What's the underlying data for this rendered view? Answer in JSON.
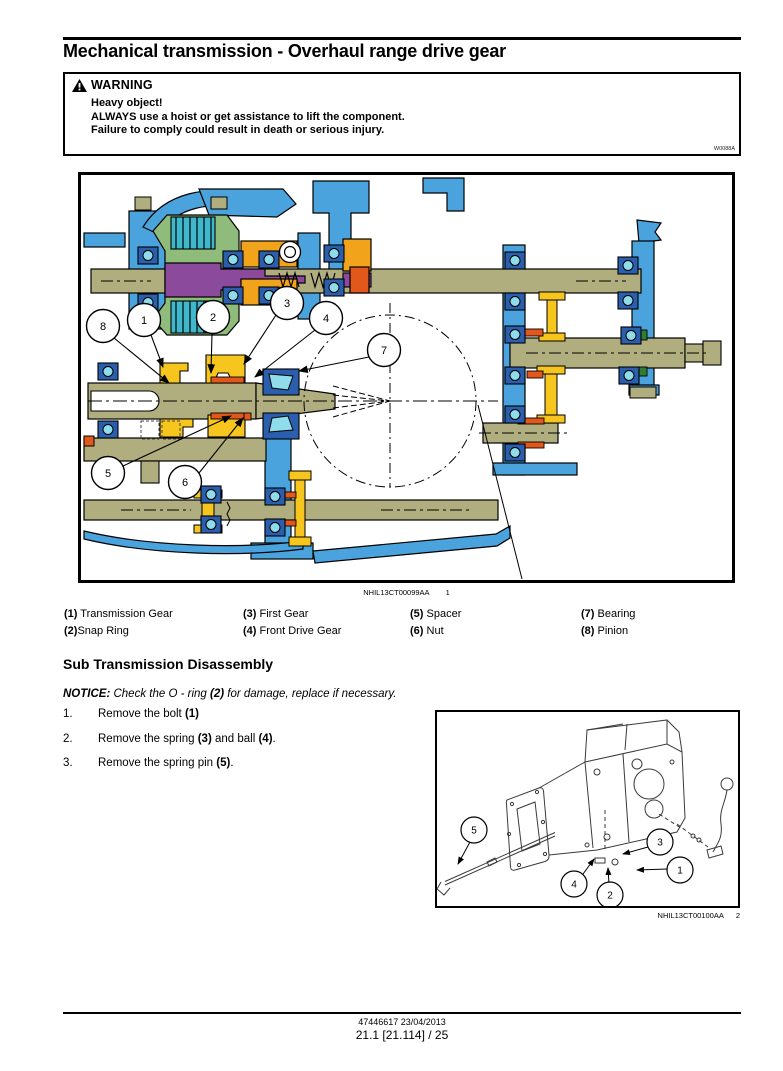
{
  "page": {
    "header": "Transmission - Mechanical transmission",
    "title": "Mechanical transmission - Overhaul range drive gear",
    "footer": {
      "line1": "47446617 23/04/2013",
      "line2": "21.1 [21.114] / 25"
    }
  },
  "warning": {
    "title": "WARNING",
    "lines": [
      "Heavy object!",
      "ALWAYS use a hoist or get assistance to lift the component.",
      "Failure to comply could result in death or serious injury."
    ],
    "code": "W0088A"
  },
  "figure1": {
    "caption_code": "NHIL13CT00099AA",
    "caption_num": "1",
    "callouts": [
      "8",
      "1",
      "2",
      "3",
      "4",
      "7",
      "5",
      "6"
    ]
  },
  "legend": {
    "items": [
      {
        "num": "(1)",
        "label": " Transmission Gear"
      },
      {
        "num": "(2)",
        "label": "Snap Ring"
      },
      {
        "num": "(3)",
        "label": " First Gear"
      },
      {
        "num": "(4)",
        "label": " Front Drive Gear"
      },
      {
        "num": "(5)",
        "label": " Spacer"
      },
      {
        "num": "(6)",
        "label": " Nut"
      },
      {
        "num": "(7)",
        "label": " Bearing"
      },
      {
        "num": "(8)",
        "label": " Pinion"
      }
    ]
  },
  "section": {
    "heading": "Sub Transmission Disassembly",
    "notice": {
      "label": "NOTICE:",
      "t1": " Check the O - ring ",
      "b1": "(2)",
      "t2": " for damage, replace if necessary."
    },
    "steps": [
      {
        "num": "1.",
        "t1": "Remove the bolt ",
        "b1": "(1)",
        "t2": "",
        "b2": "",
        "t3": ""
      },
      {
        "num": "2.",
        "t1": "Remove the spring ",
        "b1": "(3)",
        "t2": " and ball ",
        "b2": "(4)",
        "t3": "."
      },
      {
        "num": "3.",
        "t1": "Remove the spring pin ",
        "b1": "(5)",
        "t2": "",
        "b2": "",
        "t3": "."
      }
    ]
  },
  "figure2": {
    "caption_code": "NHIL13CT00100AA",
    "caption_num": "2",
    "callouts": [
      "5",
      "4",
      "2",
      "3",
      "1"
    ]
  },
  "colors": {
    "housing_blue": "#4aa3dc",
    "shaft_olive": "#b0ad7e",
    "gear_yellow": "#f6c51e",
    "carrier_amber": "#f2a31c",
    "seal_orange": "#e2571b",
    "clutch_green": "#8fbc7a",
    "disc_teal": "#3fb8cc",
    "hub_purple": "#8b4a9b",
    "bearing_blue": "#2b5fae",
    "ball_cyan": "#8fdceb"
  }
}
